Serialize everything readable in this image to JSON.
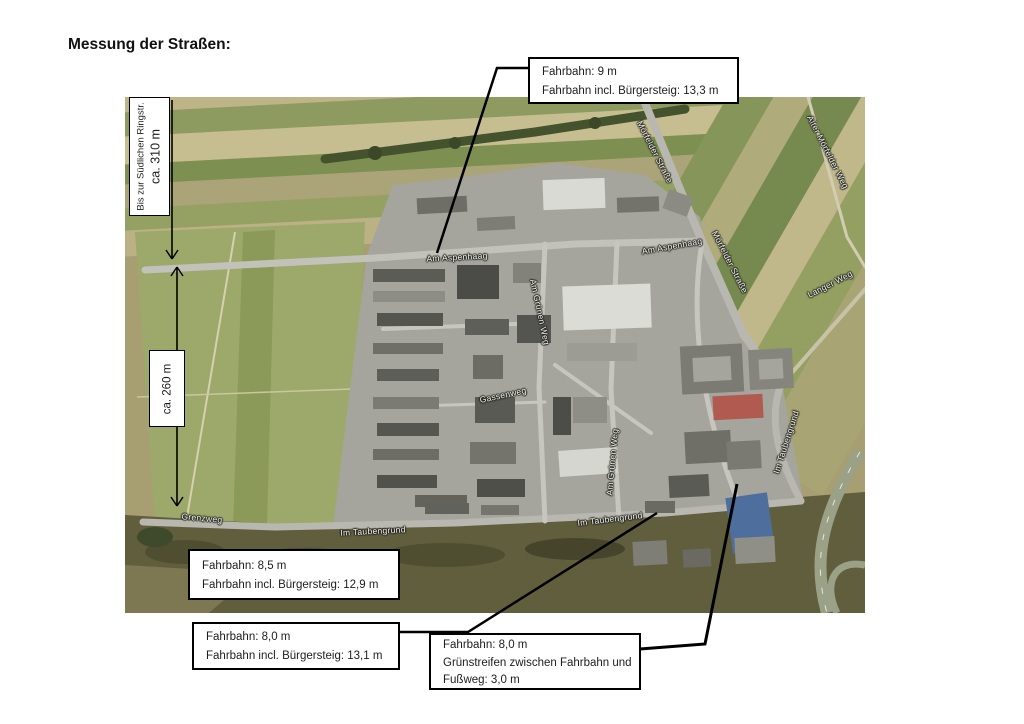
{
  "page": {
    "title": "Messung der Straßen:"
  },
  "colors": {
    "callout_border": "#000000",
    "page_background": "#ffffff",
    "label_text": "#f4f4ef"
  },
  "measurements": {
    "ringstrasse": {
      "line1": "Bis zur Südlichen Ringstr.",
      "line2": "ca. 310 m"
    },
    "field": {
      "line1": "ca. 260 m"
    }
  },
  "callouts": {
    "top": {
      "lines": [
        "Fahrbahn: 9 m",
        "Fahrbahn incl. Bürgersteig: 13,3 m"
      ]
    },
    "bottom_left": {
      "lines": [
        "Fahrbahn: 8,5 m",
        "Fahrbahn incl. Bürgersteig: 12,9 m"
      ]
    },
    "bottom_middle": {
      "lines": [
        "Fahrbahn: 8,0 m",
        "Fahrbahn incl. Bürgersteig: 13,1 m"
      ]
    },
    "bottom_right": {
      "lines": [
        "Fahrbahn: 8,0 m",
        "Grünstreifen zwischen Fahrbahn und",
        "Fußweg: 3,0 m"
      ]
    }
  },
  "map": {
    "street_labels": [
      {
        "text": "Am Aspenhaag"
      },
      {
        "text": "Am Aspenhaag"
      },
      {
        "text": "Mörfelder Straße"
      },
      {
        "text": "Mörfelder Straße"
      },
      {
        "text": "Alter Mörfelder Weg"
      },
      {
        "text": "Langer Weg"
      },
      {
        "text": "Grenzweg"
      },
      {
        "text": "Im Taubengrund"
      },
      {
        "text": "Im Taubengrund"
      },
      {
        "text": "Im Taubengrund"
      },
      {
        "text": "Am Grünen Weg"
      },
      {
        "text": "Am Grünen Weg"
      },
      {
        "text": "Gassenweg"
      }
    ]
  }
}
